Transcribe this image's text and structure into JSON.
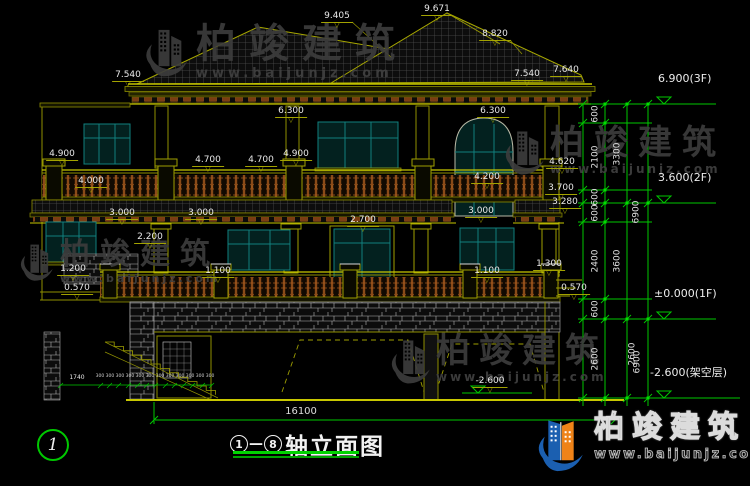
{
  "title_block": {
    "axis_from": "1",
    "separator": "—",
    "axis_to": "8",
    "text": "轴立面图"
  },
  "axis_bubbles": {
    "left": "1"
  },
  "watermark": {
    "brand": "柏竣建筑",
    "url": "www.baijunjz.com"
  },
  "logo": {
    "brand": "柏竣建筑",
    "url": "www.baijunjz.com"
  },
  "colors": {
    "background": "#000000",
    "line_olive": "#8f8f00",
    "line_bright": "#c8c800",
    "dim_green": "#00c800",
    "window_teal": "#11807e",
    "railing_brown": "#8a4a18",
    "dim_text": "#e8e8e8"
  },
  "elevation_markers": [
    {
      "text": "6.900(3F)",
      "x": 658,
      "y": 86
    },
    {
      "text": "3.600(2F)",
      "x": 658,
      "y": 185
    },
    {
      "text": "±0.000(1F)",
      "x": 654,
      "y": 301
    },
    {
      "text": "-2.600(架空层)",
      "x": 650,
      "y": 380
    }
  ],
  "dim_labels": [
    {
      "t": "7.540",
      "x": 128,
      "y": 71
    },
    {
      "t": "9.405",
      "x": 337,
      "y": 12
    },
    {
      "t": "9.671",
      "x": 437,
      "y": 5
    },
    {
      "t": "8.820",
      "x": 495,
      "y": 30
    },
    {
      "t": "7.540",
      "x": 527,
      "y": 70
    },
    {
      "t": "7.640",
      "x": 566,
      "y": 66
    },
    {
      "t": "6.300",
      "x": 291,
      "y": 107
    },
    {
      "t": "6.300",
      "x": 493,
      "y": 107
    },
    {
      "t": "4.900",
      "x": 62,
      "y": 150
    },
    {
      "t": "4.700",
      "x": 208,
      "y": 156
    },
    {
      "t": "4.700",
      "x": 261,
      "y": 156
    },
    {
      "t": "4.900",
      "x": 296,
      "y": 150
    },
    {
      "t": "4.000",
      "x": 91,
      "y": 177
    },
    {
      "t": "4.620",
      "x": 562,
      "y": 158
    },
    {
      "t": "4.200",
      "x": 487,
      "y": 173
    },
    {
      "t": "3.700",
      "x": 561,
      "y": 184
    },
    {
      "t": "3.280",
      "x": 565,
      "y": 198
    },
    {
      "t": "3.000",
      "x": 122,
      "y": 209
    },
    {
      "t": "3.000",
      "x": 201,
      "y": 209
    },
    {
      "t": "3.000",
      "x": 481,
      "y": 207
    },
    {
      "t": "2.700",
      "x": 363,
      "y": 216
    },
    {
      "t": "2.200",
      "x": 150,
      "y": 233
    },
    {
      "t": "1.200",
      "x": 73,
      "y": 265
    },
    {
      "t": "1.100",
      "x": 218,
      "y": 267
    },
    {
      "t": "1.100",
      "x": 487,
      "y": 267
    },
    {
      "t": "1.300",
      "x": 549,
      "y": 260
    },
    {
      "t": "0.570",
      "x": 77,
      "y": 284
    },
    {
      "t": "0.570",
      "x": 574,
      "y": 284
    },
    {
      "t": "-2.600",
      "x": 490,
      "y": 377
    },
    {
      "t": "1740",
      "x": 77,
      "y": 375,
      "c": "s nb"
    },
    {
      "t": "300 300 300 300 300 300 300 300 300 300 300 300",
      "x": 155,
      "y": 375,
      "c": "xs nb"
    },
    {
      "t": "16100",
      "x": 301,
      "y": 407,
      "c": "big nb"
    }
  ],
  "vdims": [
    {
      "t": "600",
      "x": 596,
      "y": 114
    },
    {
      "t": "2100",
      "x": 596,
      "y": 157
    },
    {
      "t": "600",
      "x": 596,
      "y": 197
    },
    {
      "t": "600",
      "x": 596,
      "y": 213
    },
    {
      "t": "2400",
      "x": 596,
      "y": 261
    },
    {
      "t": "600",
      "x": 596,
      "y": 309
    },
    {
      "t": "2600",
      "x": 596,
      "y": 359
    },
    {
      "t": "3300",
      "x": 618,
      "y": 154
    },
    {
      "t": "3600",
      "x": 618,
      "y": 261
    },
    {
      "t": "6900",
      "x": 637,
      "y": 212
    },
    {
      "t": "2600",
      "x": 633,
      "y": 354
    },
    {
      "t": "6900",
      "x": 638,
      "y": 362
    }
  ]
}
